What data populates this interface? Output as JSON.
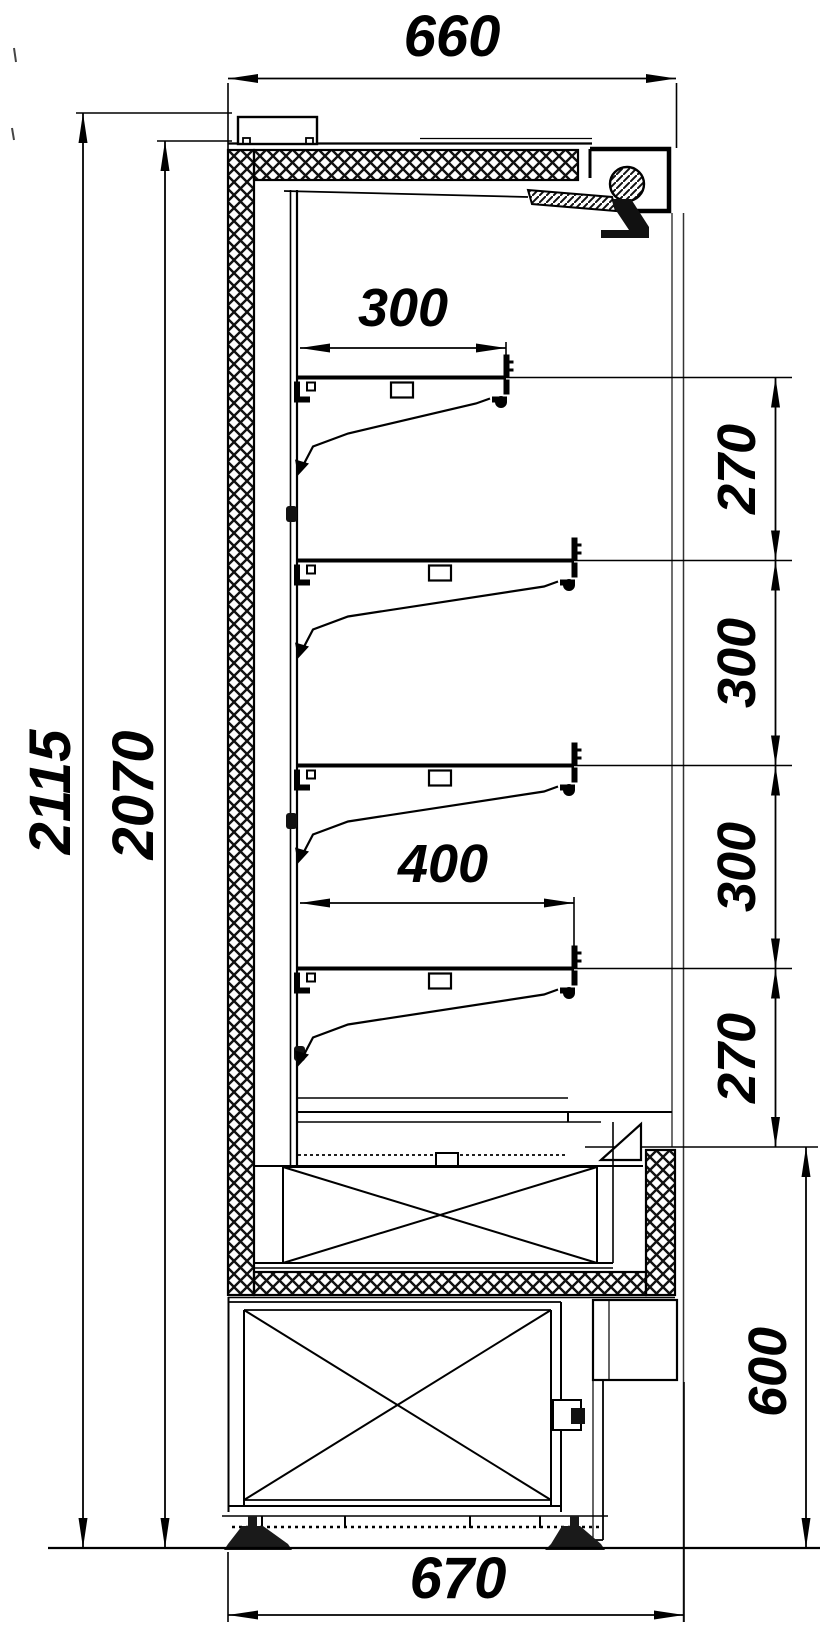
{
  "colors": {
    "line": "#000000",
    "background": "#ffffff"
  },
  "drawing": {
    "type": "technical-cross-section",
    "labels": {
      "width_top": "660",
      "height_overall": "2115",
      "height_inner": "2070",
      "shelf_small_depth": "300",
      "shelf_large_depth": "400",
      "base_height": "600",
      "depth_bottom": "670"
    },
    "shelf_gap_labels": [
      "270",
      "300",
      "300",
      "270"
    ]
  }
}
